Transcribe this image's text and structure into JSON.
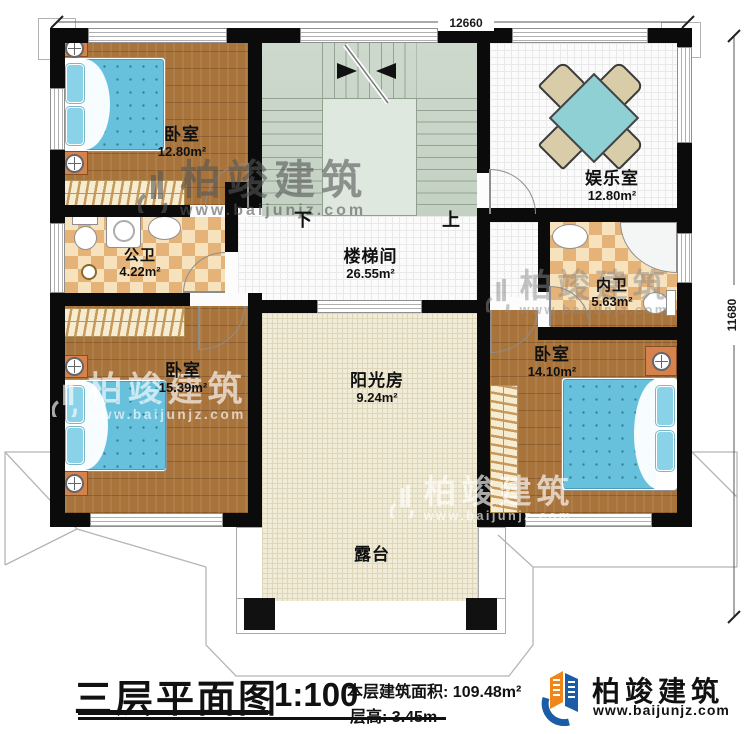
{
  "dimensions": {
    "top": "12660",
    "right": "11680"
  },
  "rooms": {
    "bedroom_tl": {
      "name": "卧室",
      "area": "12.80m²"
    },
    "entertainment": {
      "name": "娱乐室",
      "area": "12.80m²"
    },
    "stairwell": {
      "name": "楼梯间",
      "area": "26.55m²"
    },
    "public_bath": {
      "name": "公卫",
      "area": "4.22m²"
    },
    "inner_bath": {
      "name": "内卫",
      "area": "5.63m²"
    },
    "bedroom_bl": {
      "name": "卧室",
      "area": "15.39m²"
    },
    "bedroom_br": {
      "name": "卧室",
      "area": "14.10m²"
    },
    "sunroom": {
      "name": "阳光房",
      "area": "9.24m²"
    },
    "terrace": {
      "name": "露台"
    }
  },
  "stairs": {
    "down": "下",
    "up": "上"
  },
  "title_block": {
    "plan_title": "三层平面图",
    "scale": "1:100",
    "area_label": "本层建筑面积:",
    "area_value": "109.48m²",
    "floor_height_label": "层高:",
    "floor_height_value": "3.45m"
  },
  "brand": {
    "name": "柏竣建筑",
    "website": "www.baijunjz.com"
  },
  "watermark": {
    "name": "柏竣建筑",
    "website": "www.baijunjz.com"
  },
  "colors": {
    "wall": "#0b0b0b",
    "wood_floor": "#a8743c",
    "stair_floor": "#c9d6c9",
    "tile_floor": "#fbfbfb",
    "bath_floor": "#e5b378",
    "sun_floor": "#f1ecd7",
    "bed": "#67c1dc",
    "logo_blue": "#1c5ba6",
    "logo_orange": "#f08519"
  }
}
